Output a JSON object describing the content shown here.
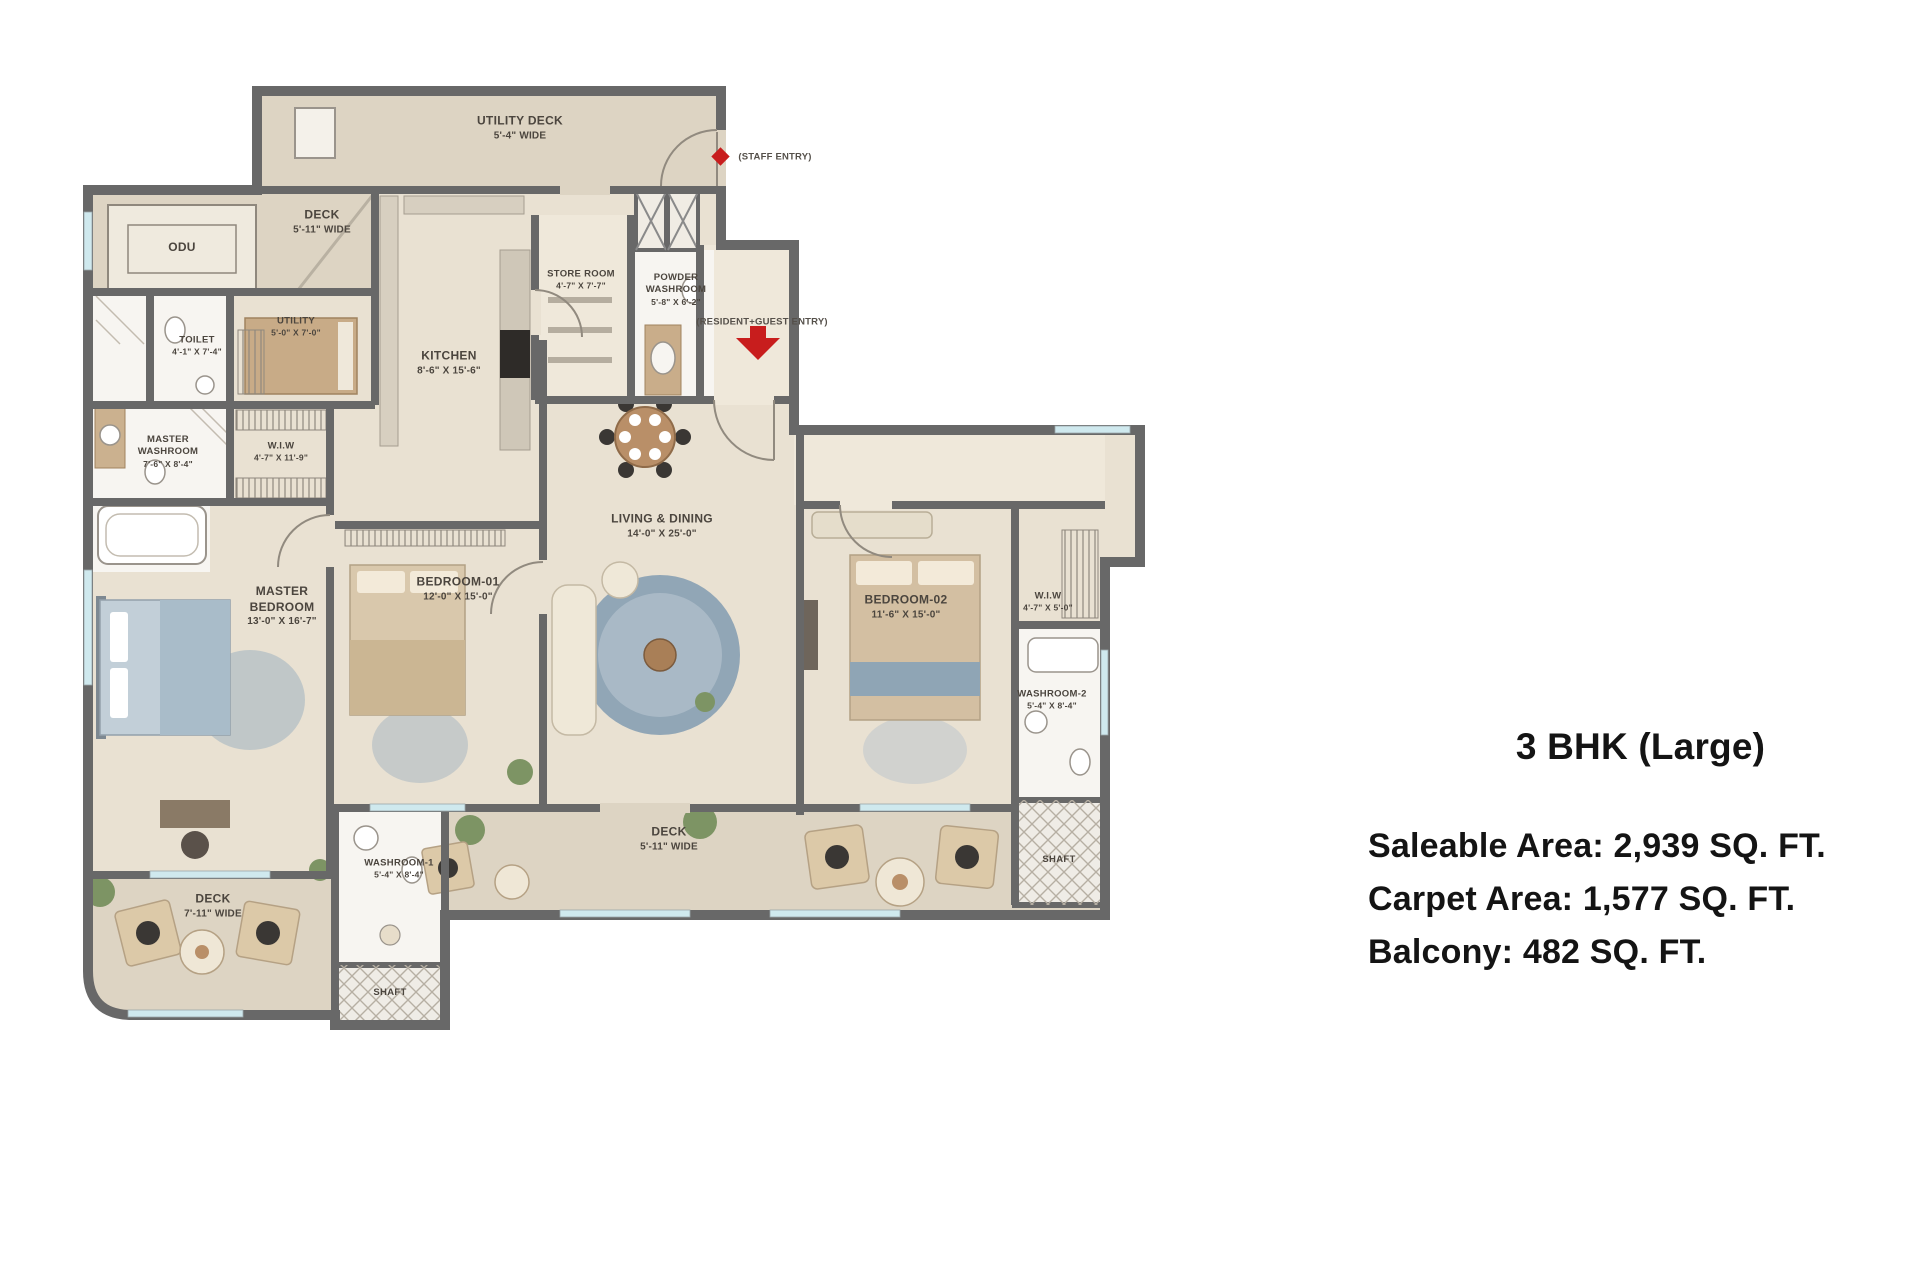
{
  "panel": {
    "title": "3 BHK (Large)",
    "saleable": "Saleable Area: 2,939 SQ. FT.",
    "carpet": "Carpet Area: 1,577 SQ. FT.",
    "balcony": "Balcony: 482 SQ. FT."
  },
  "fp": {
    "rooms": {
      "utility_deck": {
        "name": "UTILITY DECK",
        "dim": "5'-4\" WIDE"
      },
      "deck_left": {
        "name": "DECK",
        "dim": "5'-11\" WIDE"
      },
      "odu": {
        "name": "ODU",
        "dim": ""
      },
      "store_room": {
        "name": "STORE ROOM",
        "dim": "4'-7\" X 7'-7\""
      },
      "powder_washroom": {
        "name": "POWDER WASHROOM",
        "dim": "5'-8\" X 6'-2\""
      },
      "utility": {
        "name": "UTILITY",
        "dim": "5'-0\" X 7'-0\""
      },
      "toilet": {
        "name": "TOILET",
        "dim": "4'-1\" X 7'-4\""
      },
      "kitchen": {
        "name": "KITCHEN",
        "dim": "8'-6\" X 15'-6\""
      },
      "master_washroom": {
        "name": "MASTER WASHROOM",
        "dim": "7'-6\" X 8'-4\""
      },
      "wiw_master": {
        "name": "W.I.W",
        "dim": "4'-7\" X 11'-9\""
      },
      "living_dining": {
        "name": "LIVING & DINING",
        "dim": "14'-0\" X 25'-0\""
      },
      "master_bedroom": {
        "name": "MASTER BEDROOM",
        "dim": "13'-0\" X 16'-7\""
      },
      "bedroom_01": {
        "name": "BEDROOM-01",
        "dim": "12'-0\" X 15'-0\""
      },
      "bedroom_02": {
        "name": "BEDROOM-02",
        "dim": "11'-6\" X 15'-0\""
      },
      "wiw_2": {
        "name": "W.I.W",
        "dim": "4'-7\" X 5'-0\""
      },
      "washroom_02": {
        "name": "WASHROOM-2",
        "dim": "5'-4\" X 8'-4\""
      },
      "deck_bottom": {
        "name": "DECK",
        "dim": "5'-11\" WIDE"
      },
      "washroom_1": {
        "name": "WASHROOM-1",
        "dim": "5'-4\" X 8'-4\""
      },
      "deck_bottom_left": {
        "name": "DECK",
        "dim": "7'-11\" WIDE"
      },
      "shaft_right": {
        "name": "SHAFT",
        "dim": ""
      },
      "shaft_bottom": {
        "name": "SHAFT",
        "dim": ""
      }
    },
    "entries": {
      "staff": {
        "label": "(STAFF ENTRY)"
      },
      "resident": {
        "label": "(RESIDENT+GUEST ENTRY)"
      }
    },
    "colors": {
      "wall": "#686868",
      "floor": "#e9e1d2",
      "deck": "#ddd4c3",
      "white_room": "#f7f5f1",
      "accent_red": "#c81d1d",
      "rug_blue": "#91a6b6",
      "wood": "#b98f68",
      "plant": "#7d9464"
    }
  }
}
